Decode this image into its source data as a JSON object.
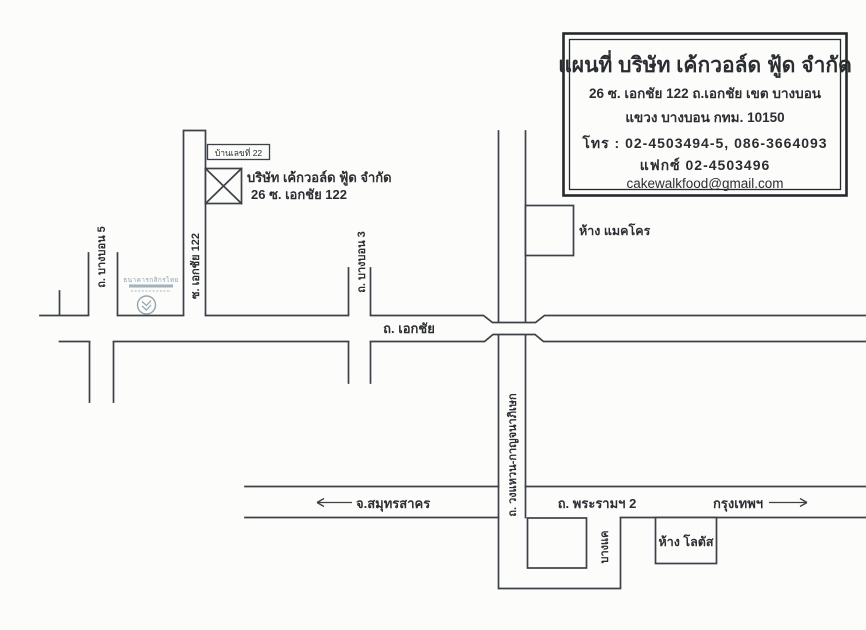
{
  "info_box": {
    "title": "แผนที่ บริษัท เค้กวอล์ด ฟู้ด จำกัด",
    "address_line1": "26 ซ. เอกชัย 122 ถ.เอกชัย เขต บางบอน",
    "address_line2": "แขวง บางบอน กทม. 10150",
    "phone": "โทร : 02-4503494-5, 086-3664093",
    "fax": "แฟกซ์ 02-4503496",
    "email": "cakewalkfood@gmail.com"
  },
  "map": {
    "company": {
      "house_number": "บ้านเลขที่ 22",
      "name": "บริษัท เค้กวอล์ด ฟู้ด จำกัด",
      "address": "26 ซ. เอกชัย 122"
    },
    "bank_name": "ธนาคารกสิกรไทย",
    "roads": {
      "ekachai": "ถ. เอกชัย",
      "soi_ekachai_122": "ซ. เอกชัย 122",
      "bang_bon_5": "ถ. บางบอน 5",
      "bang_bon_3": "ถ. บางบอน 3",
      "wong_waen_kanchanaphisek": "ถ. วงแหวน-กาญจนาภิเษก",
      "rama_2": "ถ. พระรามฯ 2",
      "bang_khae": "บางแค"
    },
    "places": {
      "makro": "ห้าง แมคโคร",
      "lotus": "ห้าง โลตัส"
    },
    "directions": {
      "west": "จ.สมุทรสาคร",
      "east": "กรุงเทพฯ"
    }
  },
  "colors": {
    "ink": "#2b2e31",
    "road_line": "#3c4247",
    "bank_faint": "#93a5b1",
    "paper": "#fcfcfb"
  }
}
